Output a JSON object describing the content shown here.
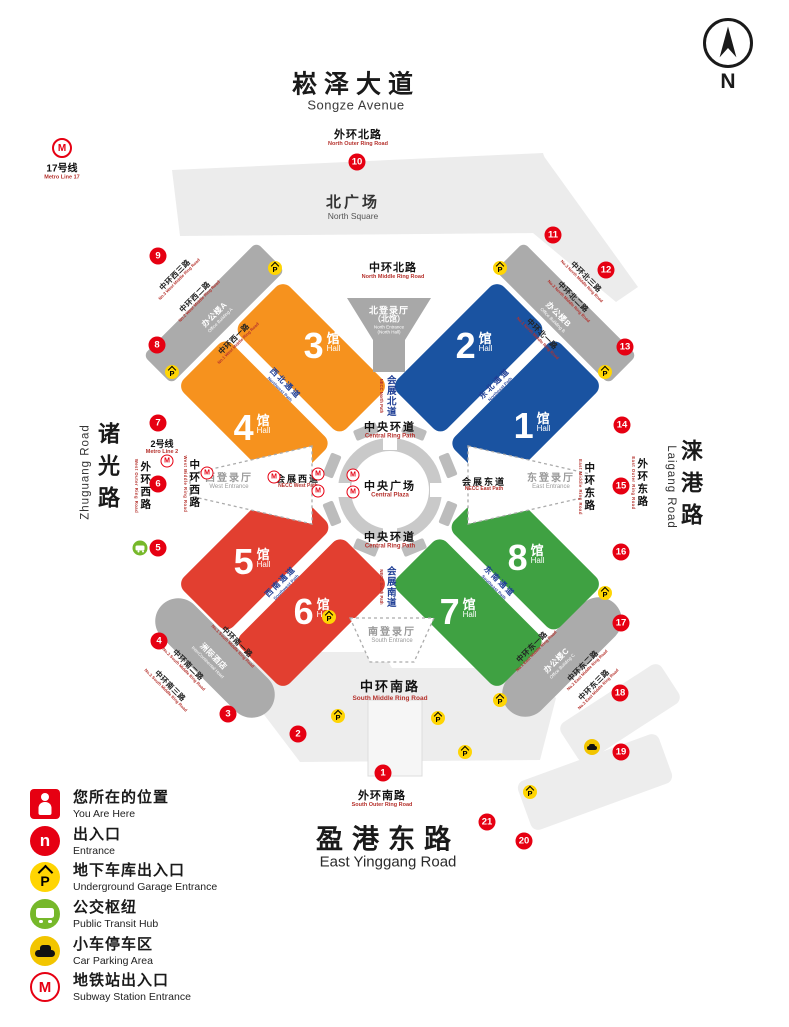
{
  "compass": {
    "label": "N"
  },
  "icons": {
    "p": "P",
    "metro": "M",
    "entrance": "n"
  },
  "roads": {
    "songze": {
      "zh": "崧泽大道",
      "en": "Songze Avenue"
    },
    "yinggang": {
      "zh": "盈港东路",
      "en": "East Yinggang Road"
    },
    "zhuguang": {
      "zh": "诸光路",
      "en": "Zhuguang Road"
    },
    "laigang": {
      "zh": "涞港路",
      "en": "Laigang Road"
    },
    "outer_north": {
      "zh": "外环北路",
      "en": "North Outer Ring Road"
    },
    "middle_north": {
      "zh": "中环北路",
      "en": "North Middle Ring Road"
    },
    "outer_west": {
      "zh": "外环西路",
      "en": "West Outer Ring Road"
    },
    "middle_west": {
      "zh": "中环西路",
      "en": "West Middle Ring Road"
    },
    "outer_east": {
      "zh": "外环东路",
      "en": "East Outer Ring Road"
    },
    "middle_east": {
      "zh": "中环东路",
      "en": "East Middle Ring Road"
    },
    "outer_south": {
      "zh": "外环南路",
      "en": "South Outer Ring Road"
    },
    "middle_south": {
      "zh": "中环南路",
      "en": "South Middle Ring Road"
    },
    "w1": {
      "zh": "中环西一路",
      "en": "No.1 West Middle Ring Road"
    },
    "w2": {
      "zh": "中环西二路",
      "en": "No.2 West Middle Ring Road"
    },
    "w3": {
      "zh": "中环西三路",
      "en": "No.3 West Middle Ring Road"
    },
    "n1": {
      "zh": "中环北一路",
      "en": "No.1 North Middle Ring Road"
    },
    "n2": {
      "zh": "中环北二路",
      "en": "No.2 North Middle Ring Road"
    },
    "n3": {
      "zh": "中环北三路",
      "en": "No.3 North Middle Ring Road"
    },
    "s1": {
      "zh": "中环南一路",
      "en": "No.1 South Middle Ring Road"
    },
    "s2": {
      "zh": "中环南二路",
      "en": "No.2 South Middle Ring Road"
    },
    "s3": {
      "zh": "中环南三路",
      "en": "No.3 South Middle Ring Road"
    },
    "e1": {
      "zh": "中环东一路",
      "en": "No.1 East Middle Ring Road"
    },
    "e2": {
      "zh": "中环东二路",
      "en": "No.2 East Middle Ring Road"
    },
    "e3": {
      "zh": "中环东三路",
      "en": "No.3 East Middle Ring Road"
    }
  },
  "paths": {
    "central_ring": {
      "zh": "中央环道",
      "en": "Central Ring Path"
    },
    "nw": {
      "zh": "西北通道",
      "en": "Northwest Path"
    },
    "ne": {
      "zh": "东北通道",
      "en": "Northeast Path"
    },
    "sw": {
      "zh": "西南通道",
      "en": "Southwest Path"
    },
    "se": {
      "zh": "东南通道",
      "en": "Southeast Path"
    },
    "necc_n": {
      "zh": "会展北道",
      "en": "NECC North Path"
    },
    "necc_s": {
      "zh": "会展南道",
      "en": "NECC South Path"
    },
    "necc_w": {
      "zh": "会展西道",
      "en": "NECC West Path"
    },
    "necc_e": {
      "zh": "会展东道",
      "en": "NECC East Path"
    }
  },
  "areas": {
    "north_square": {
      "zh": "北广场",
      "en": "North Square"
    },
    "central_plaza": {
      "zh": "中央广场",
      "en": "Central Plaza"
    },
    "north_hall": {
      "zh": "北登录厅",
      "zh2": "（北馆）",
      "en": "North Entrance",
      "en2": "(North Hall)"
    },
    "west_hall": {
      "zh": "西登录厅",
      "en": "West Entrance"
    },
    "east_hall": {
      "zh": "东登录厅",
      "en": "East Entrance"
    },
    "south_hall": {
      "zh": "南登录厅",
      "en": "South Entrance"
    },
    "office_a": {
      "zh": "办公楼A",
      "en": "Office Building A"
    },
    "office_b": {
      "zh": "办公楼B",
      "en": "Office Building B"
    },
    "office_c": {
      "zh": "办公楼C",
      "en": "Office Building C"
    },
    "hotel": {
      "zh": "洲际酒店",
      "en": "InterContinental Hotel"
    }
  },
  "halls": {
    "unit": "馆",
    "unit_en": "Hall",
    "numbers": [
      "1",
      "2",
      "3",
      "4",
      "5",
      "6",
      "7",
      "8"
    ]
  },
  "metro": {
    "line17": {
      "zh": "17号线",
      "en": "Metro Line 17"
    },
    "line2": {
      "zh": "2号线",
      "en": "Metro Line 2"
    }
  },
  "entrances": [
    "1",
    "2",
    "3",
    "4",
    "5",
    "6",
    "7",
    "8",
    "9",
    "10",
    "11",
    "12",
    "13",
    "14",
    "15",
    "16",
    "17",
    "18",
    "19",
    "20",
    "21"
  ],
  "legend": [
    {
      "zh": "您所在的位置",
      "en": "You Are Here"
    },
    {
      "zh": "出入口",
      "en": "Entrance"
    },
    {
      "zh": "地下车库出入口",
      "en": "Underground Garage Entrance"
    },
    {
      "zh": "公交枢纽",
      "en": "Public Transit Hub"
    },
    {
      "zh": "小车停车区",
      "en": "Car Parking Area"
    },
    {
      "zh": "地铁站出入口",
      "en": "Subway Station Entrance"
    }
  ]
}
